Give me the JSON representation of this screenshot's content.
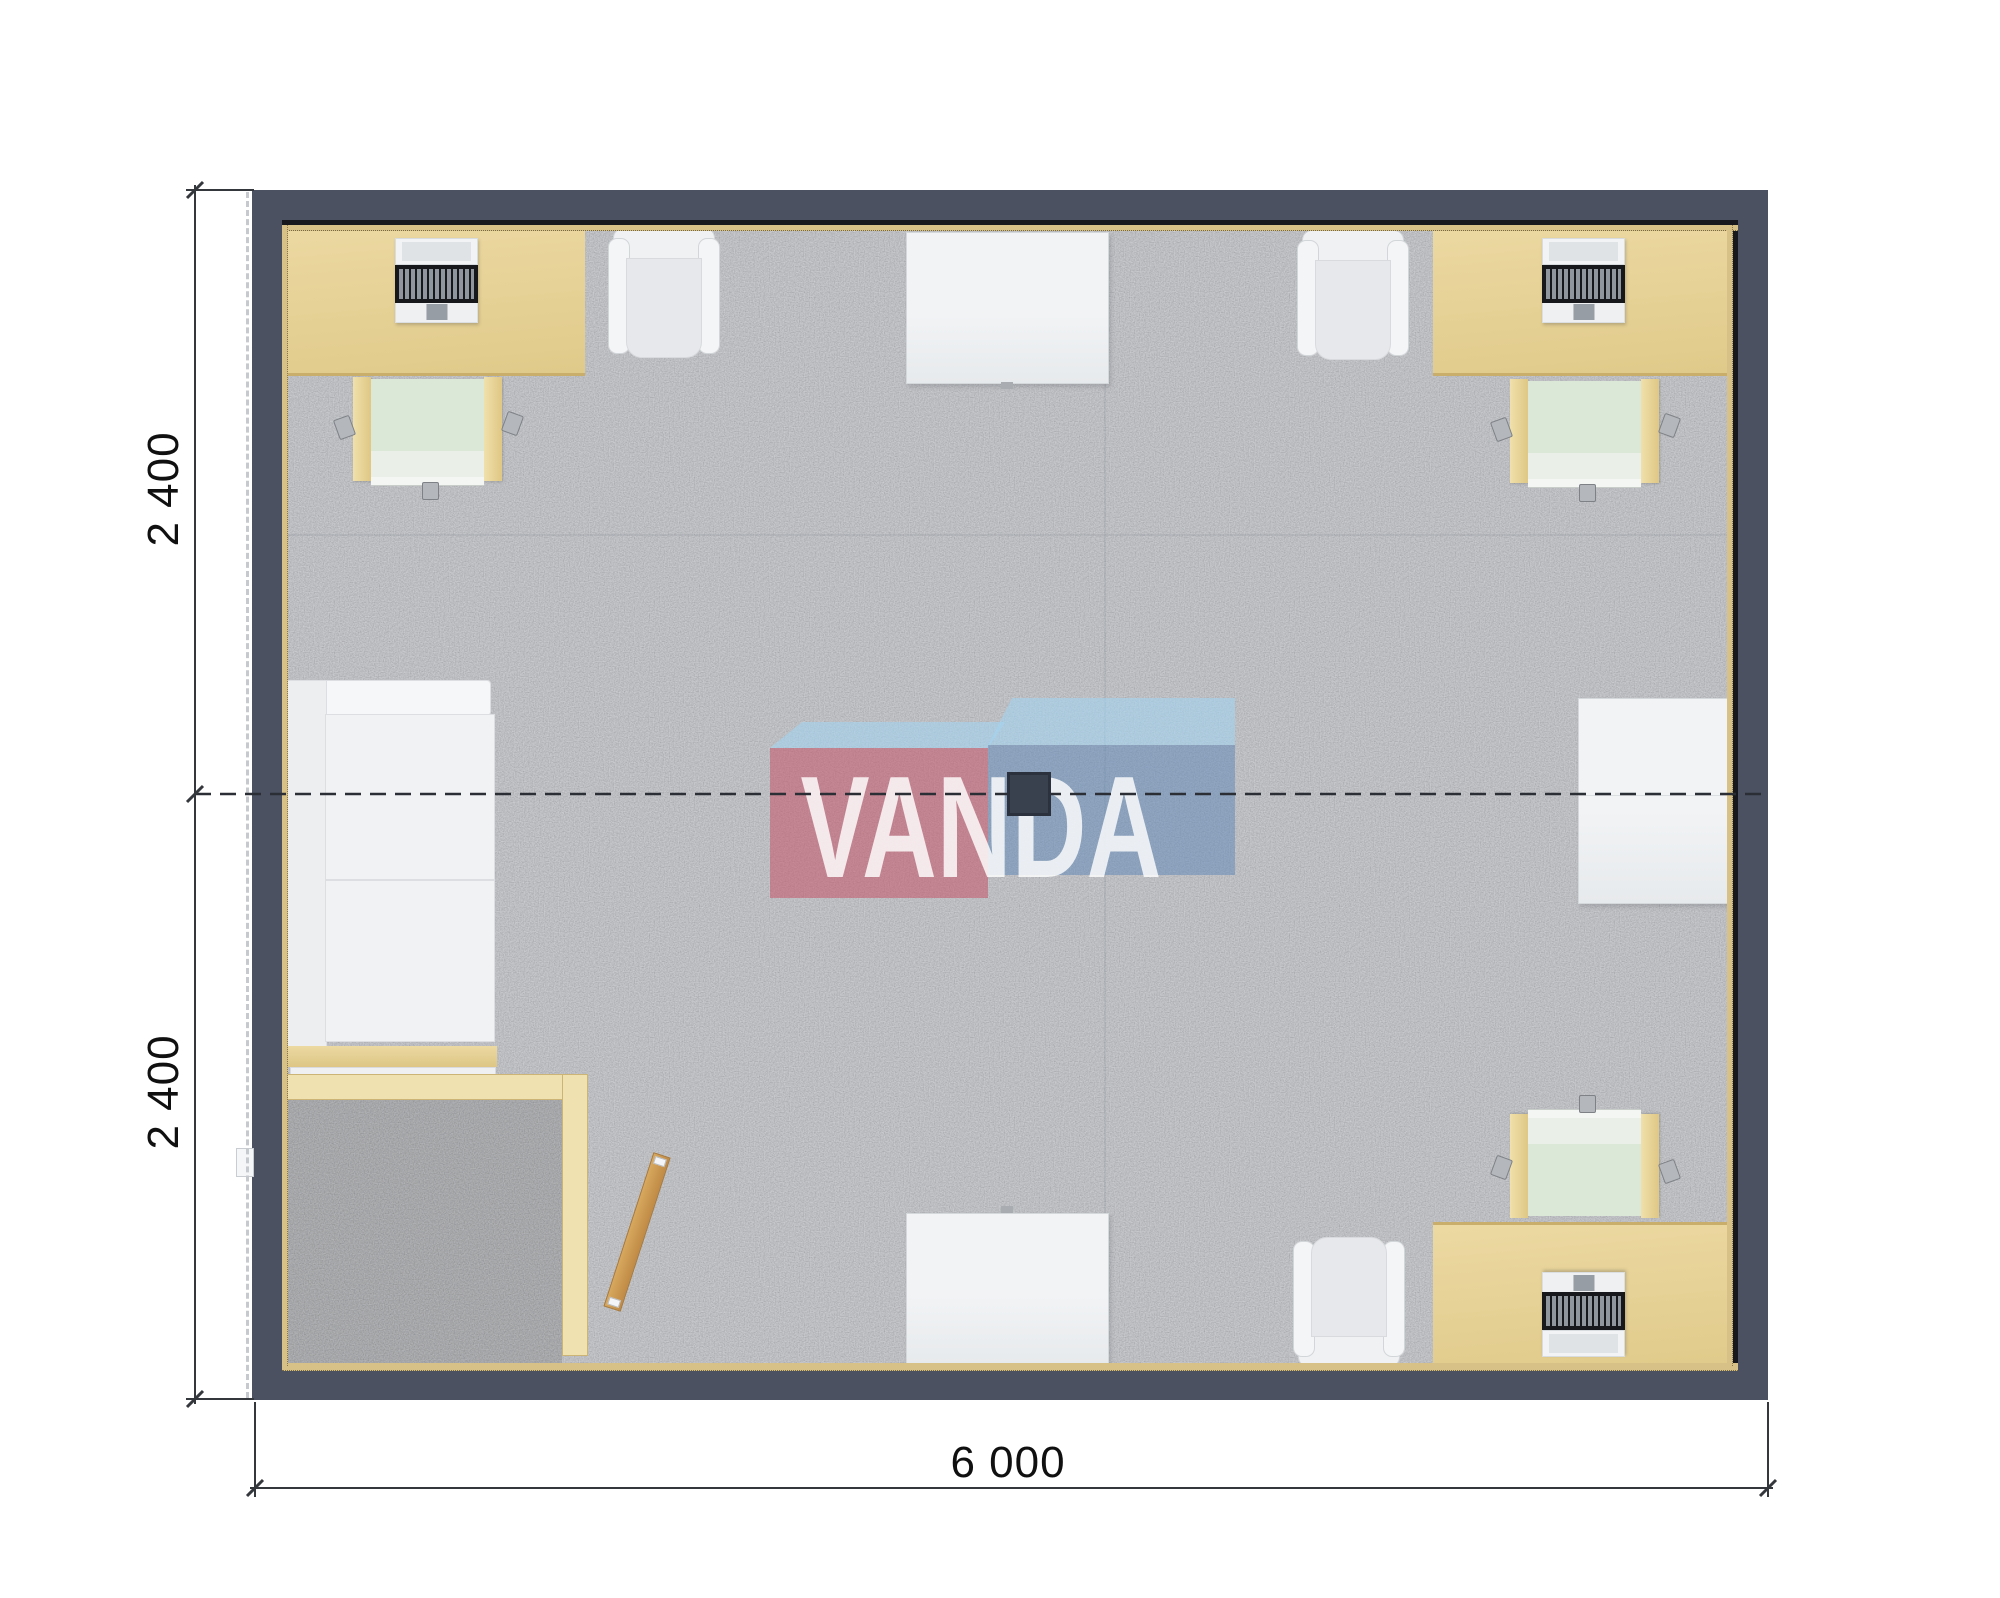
{
  "dimension_annotations": {
    "left_top": "2 400",
    "left_bottom": "2 400",
    "bottom": "6 000"
  },
  "watermark": {
    "text": "VANDA"
  },
  "plan_objects": [
    "desk",
    "laptop",
    "desk-chair",
    "armchair",
    "meeting-table",
    "sofa",
    "kitchen-counter",
    "entry-vestibule",
    "entry-door",
    "exterior-step",
    "side-cabinet",
    "ceiling-lamp",
    "section-line",
    "dimension-line"
  ],
  "colors": {
    "wall": "#4b5160",
    "wall_line": "#16181d",
    "trim": "#d8c186",
    "carpet": "#bcbfc6",
    "carpet_entry": "#97999d",
    "desk_a": "#ecd9a2",
    "desk_b": "#e0ca8a",
    "desk_edge": "#c9ae6b",
    "chair_frame_a": "#f0e0ab",
    "chair_frame_b": "#dfc784",
    "chair_seat": "#dce8d7",
    "chair_seat_front": "#eaf0e8",
    "white_a": "#f1f3f5",
    "white_b": "#e7eaec",
    "furn_border": "#d5d8db",
    "partition": "#efe2b0",
    "partition_border": "#ccb477",
    "door_a": "#d8a85e",
    "door_b": "#bf8a45",
    "lamp": "#3a414e",
    "notch": "#a9adb2",
    "key_black": "#17181b",
    "key_gray": "#8f969d",
    "touchpad": "#969da5",
    "wheel": "#b4b7bb",
    "dim_line": "#34373c",
    "logo_red": "rgba(199,84,104,0.55)",
    "logo_blue": "rgba(96,136,185,0.52)",
    "logo_light_blue": "rgba(163,212,240,0.60)",
    "logo_text": "rgba(255,255,255,0.82)"
  }
}
